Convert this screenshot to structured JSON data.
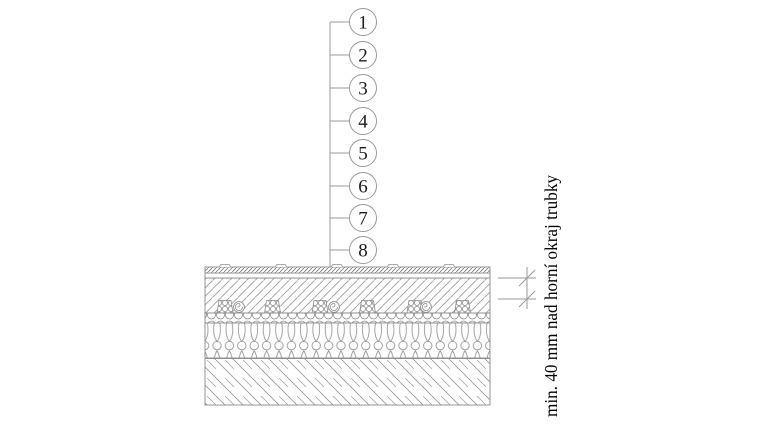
{
  "diagram": {
    "callouts": [
      {
        "label": "1"
      },
      {
        "label": "2"
      },
      {
        "label": "3"
      },
      {
        "label": "4"
      },
      {
        "label": "5"
      },
      {
        "label": "6"
      },
      {
        "label": "7"
      },
      {
        "label": "8"
      }
    ],
    "annotation": {
      "text": "min. 40 mm nad horní okraj trubky"
    },
    "colors": {
      "line_gray": "#909090",
      "ink": "#1c1c1c",
      "background": "#ffffff"
    }
  }
}
